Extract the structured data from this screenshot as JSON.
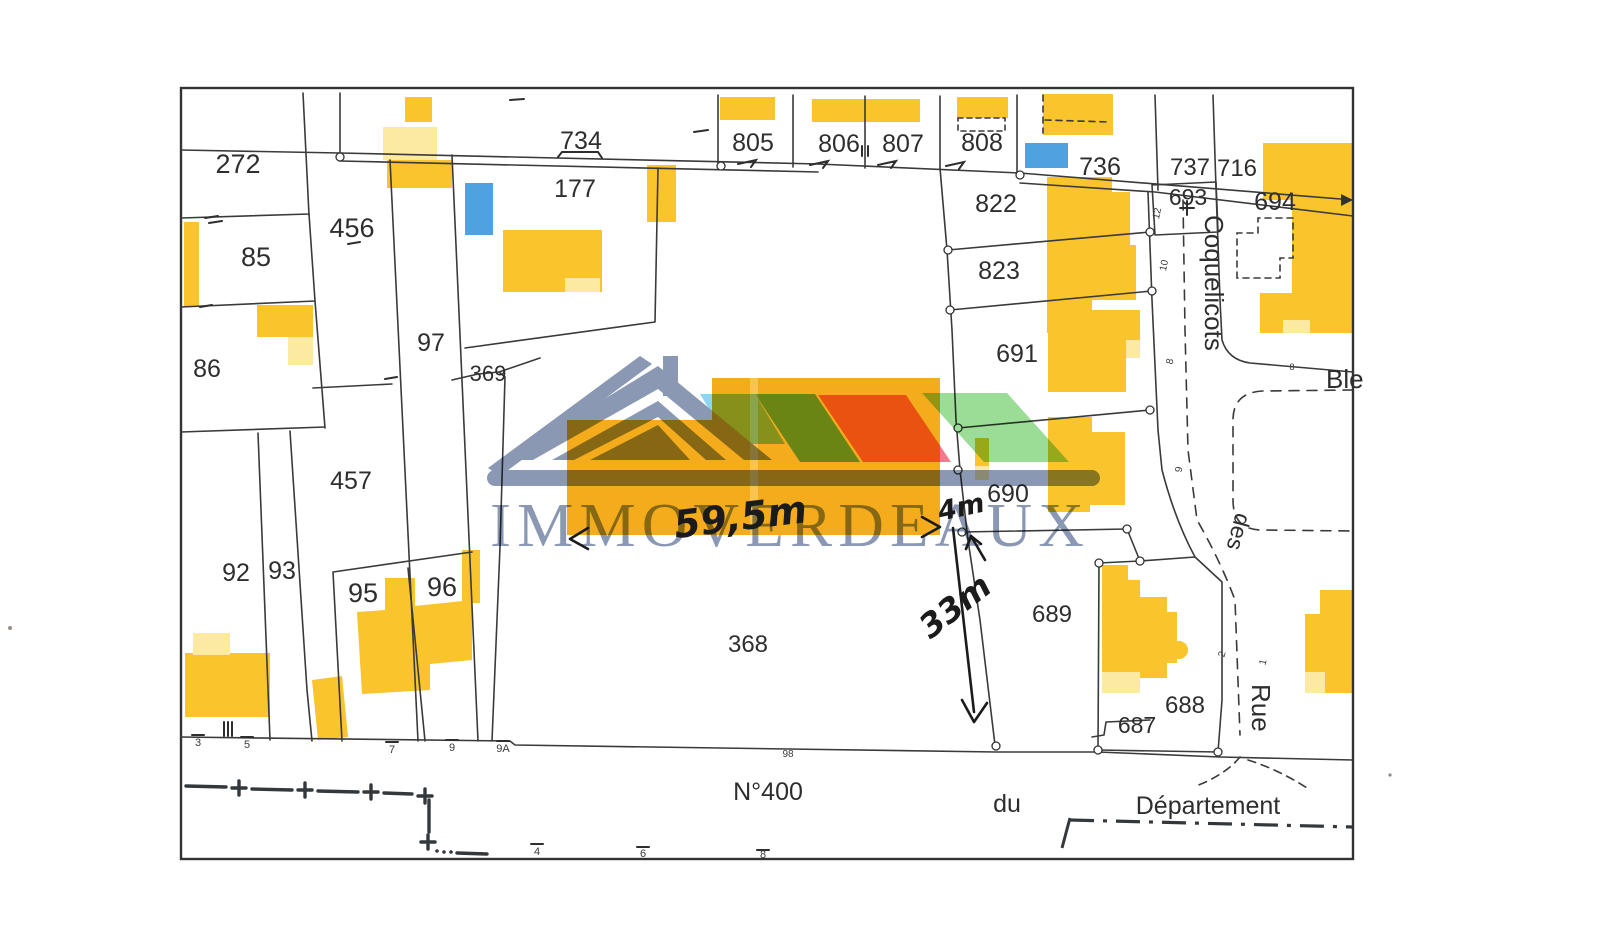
{
  "logo": {
    "brand": "IMMOVERDEAUX"
  },
  "colors": {
    "building_yellow": "#F9C42C",
    "building_pale": "#FCE9A2",
    "highlight_orange": "#F5AC1C",
    "building_blue": "#4FA1DF",
    "line": "#3A3A3A",
    "logo_slate": "#7D8DAC",
    "logo_skyblue": "#7ED3F2",
    "logo_teal": "#5FBFAF",
    "logo_pink": "#F26B80",
    "logo_green": "#90D98C"
  },
  "map": {
    "labels": [
      {
        "kind": "parcel",
        "text": "272",
        "x": 238,
        "y": 173,
        "size": 27
      },
      {
        "kind": "parcel",
        "text": "85",
        "x": 256,
        "y": 266,
        "size": 27
      },
      {
        "kind": "parcel",
        "text": "86",
        "x": 207,
        "y": 377,
        "size": 25
      },
      {
        "kind": "parcel",
        "text": "456",
        "x": 352,
        "y": 237,
        "size": 27
      },
      {
        "kind": "parcel",
        "text": "97",
        "x": 431,
        "y": 351,
        "size": 25
      },
      {
        "kind": "parcel",
        "text": "457",
        "x": 351,
        "y": 489,
        "size": 25
      },
      {
        "kind": "parcel",
        "text": "92",
        "x": 236,
        "y": 581,
        "size": 25
      },
      {
        "kind": "parcel",
        "text": "93",
        "x": 282,
        "y": 579,
        "size": 25
      },
      {
        "kind": "parcel",
        "text": "95",
        "x": 363,
        "y": 602,
        "size": 27
      },
      {
        "kind": "parcel",
        "text": "96",
        "x": 442,
        "y": 596,
        "size": 27
      },
      {
        "kind": "parcel",
        "text": "369",
        "x": 488,
        "y": 381,
        "size": 22
      },
      {
        "kind": "parcel",
        "text": "177",
        "x": 575,
        "y": 197,
        "size": 25
      },
      {
        "kind": "parcel",
        "text": "734",
        "x": 581,
        "y": 149,
        "size": 25
      },
      {
        "kind": "parcel",
        "text": "805",
        "x": 753,
        "y": 151,
        "size": 25
      },
      {
        "kind": "parcel",
        "text": "806",
        "x": 839,
        "y": 152,
        "size": 25
      },
      {
        "kind": "parcel",
        "text": "807",
        "x": 903,
        "y": 152,
        "size": 25
      },
      {
        "kind": "parcel",
        "text": "808",
        "x": 982,
        "y": 151,
        "size": 25
      },
      {
        "kind": "parcel",
        "text": "822",
        "x": 996,
        "y": 212,
        "size": 25
      },
      {
        "kind": "parcel",
        "text": "823",
        "x": 999,
        "y": 279,
        "size": 25
      },
      {
        "kind": "parcel",
        "text": "736",
        "x": 1100,
        "y": 175,
        "size": 25
      },
      {
        "kind": "parcel",
        "text": "737",
        "x": 1190,
        "y": 175,
        "size": 24
      },
      {
        "kind": "parcel",
        "text": "716",
        "x": 1237,
        "y": 176,
        "size": 24
      },
      {
        "kind": "parcel",
        "text": "693",
        "x": 1188,
        "y": 205,
        "size": 23
      },
      {
        "kind": "parcel",
        "text": "694",
        "x": 1275,
        "y": 210,
        "size": 25
      },
      {
        "kind": "parcel",
        "text": "691",
        "x": 1017,
        "y": 362,
        "size": 25
      },
      {
        "kind": "parcel",
        "text": "690",
        "x": 1008,
        "y": 502,
        "size": 25
      },
      {
        "kind": "parcel",
        "text": "689",
        "x": 1052,
        "y": 622,
        "size": 24
      },
      {
        "kind": "parcel",
        "text": "688",
        "x": 1185,
        "y": 713,
        "size": 24
      },
      {
        "kind": "parcel",
        "text": "687",
        "x": 1137,
        "y": 733,
        "size": 23
      },
      {
        "kind": "parcel",
        "text": "368",
        "x": 748,
        "y": 652,
        "size": 24
      },
      {
        "kind": "street",
        "text": "Coquelicots",
        "x": 1205,
        "y": 215,
        "size": 26,
        "rotate": 90,
        "anchor": "start",
        "cls": "street"
      },
      {
        "kind": "street",
        "text": "des",
        "x": 1236,
        "y": 512,
        "size": 23,
        "rotate": 105,
        "anchor": "start",
        "cls": "street"
      },
      {
        "kind": "street",
        "text": "Rue",
        "x": 1252,
        "y": 684,
        "size": 26,
        "rotate": 90,
        "anchor": "start",
        "cls": "street"
      },
      {
        "kind": "street",
        "text": "Ble",
        "x": 1326,
        "y": 388,
        "size": 26,
        "anchor": "start",
        "cls": "street"
      },
      {
        "kind": "street",
        "text": "N°400",
        "x": 768,
        "y": 800,
        "size": 25,
        "cls": "street"
      },
      {
        "kind": "street",
        "text": "du",
        "x": 1007,
        "y": 812,
        "size": 25,
        "cls": "street"
      },
      {
        "kind": "street",
        "text": "Département",
        "x": 1208,
        "y": 814,
        "size": 25,
        "cls": "street"
      },
      {
        "kind": "house-number",
        "text": "3",
        "x": 198,
        "y": 746,
        "size": 11,
        "cls": "hnum"
      },
      {
        "kind": "house-number",
        "text": "5",
        "x": 247,
        "y": 748,
        "size": 11,
        "cls": "hnum"
      },
      {
        "kind": "house-number",
        "text": "7",
        "x": 392,
        "y": 753,
        "size": 11,
        "cls": "hnum"
      },
      {
        "kind": "house-number",
        "text": "9",
        "x": 452,
        "y": 751,
        "size": 11,
        "cls": "hnum"
      },
      {
        "kind": "house-number",
        "text": "9A",
        "x": 503,
        "y": 752,
        "size": 11,
        "cls": "hnum"
      },
      {
        "kind": "house-number",
        "text": "98",
        "x": 788,
        "y": 757,
        "size": 10,
        "cls": "hnum"
      },
      {
        "kind": "house-number",
        "text": "4",
        "x": 537,
        "y": 855,
        "size": 11,
        "cls": "hnum"
      },
      {
        "kind": "house-number",
        "text": "6",
        "x": 643,
        "y": 857,
        "size": 11,
        "cls": "hnum"
      },
      {
        "kind": "house-number",
        "text": "8",
        "x": 763,
        "y": 858,
        "size": 11,
        "cls": "hnum"
      },
      {
        "kind": "house-number",
        "text": "12",
        "x": 1160,
        "y": 214,
        "size": 10,
        "rotate": -78,
        "cls": "hnum"
      },
      {
        "kind": "house-number",
        "text": "10",
        "x": 1167,
        "y": 266,
        "size": 10,
        "rotate": -78,
        "cls": "hnum"
      },
      {
        "kind": "house-number",
        "text": "8",
        "x": 1173,
        "y": 362,
        "size": 10,
        "rotate": -78,
        "cls": "hnum"
      },
      {
        "kind": "house-number",
        "text": "9",
        "x": 1182,
        "y": 470,
        "size": 10,
        "rotate": -80,
        "cls": "hnum"
      },
      {
        "kind": "house-number",
        "text": "2",
        "x": 1225,
        "y": 655,
        "size": 10,
        "rotate": -75,
        "cls": "hnum"
      },
      {
        "kind": "house-number",
        "text": "1",
        "x": 1266,
        "y": 663,
        "size": 10,
        "rotate": -75,
        "cls": "hnum"
      },
      {
        "kind": "house-number",
        "text": "8",
        "x": 1292,
        "y": 370,
        "size": 9,
        "cls": "hnum"
      }
    ],
    "annotations": [
      {
        "kind": "measurement",
        "text": "59,5m",
        "x": 742,
        "y": 530,
        "size": 38,
        "rotate": -7
      },
      {
        "kind": "measurement",
        "text": "4m",
        "x": 963,
        "y": 516,
        "size": 27,
        "rotate": -12
      },
      {
        "kind": "measurement",
        "text": "33m",
        "x": 962,
        "y": 615,
        "size": 33,
        "rotate": -38
      }
    ]
  }
}
